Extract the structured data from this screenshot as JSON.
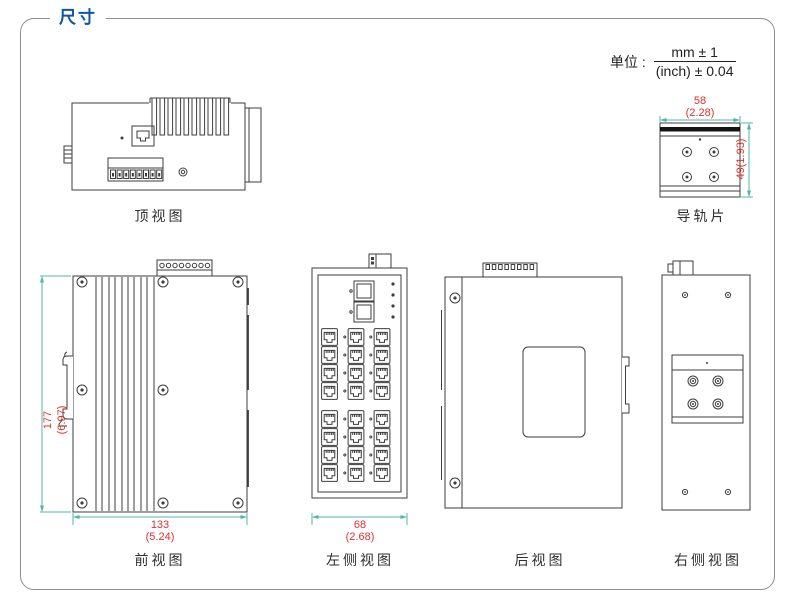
{
  "page": {
    "title": "尺寸",
    "unit_label": "单位 :",
    "unit_numerator": "mm ± 1",
    "unit_denominator": "(inch) ± 0.04"
  },
  "colors": {
    "accent_blue": "#0c57a1",
    "dimension_line": "#4db8a8",
    "dimension_text": "#e0312d",
    "line_art": "#3d3d3d",
    "frame_border": "#8e8e8e"
  },
  "views": {
    "top": {
      "label": "顶视图"
    },
    "rail": {
      "label": "导轨片",
      "dim_width_mm": "58",
      "dim_width_inch": "(2.28)",
      "dim_height": "49(1.93)"
    },
    "front": {
      "label": "前视图",
      "dim_height_mm": "177",
      "dim_height_inch": "(6.97)",
      "dim_width_mm": "133",
      "dim_width_inch": "(5.24)"
    },
    "left_side": {
      "label": "左侧视图",
      "dim_width_mm": "68",
      "dim_width_inch": "(2.68)"
    },
    "rear": {
      "label": "后视图"
    },
    "right_side": {
      "label": "右侧视图"
    }
  }
}
